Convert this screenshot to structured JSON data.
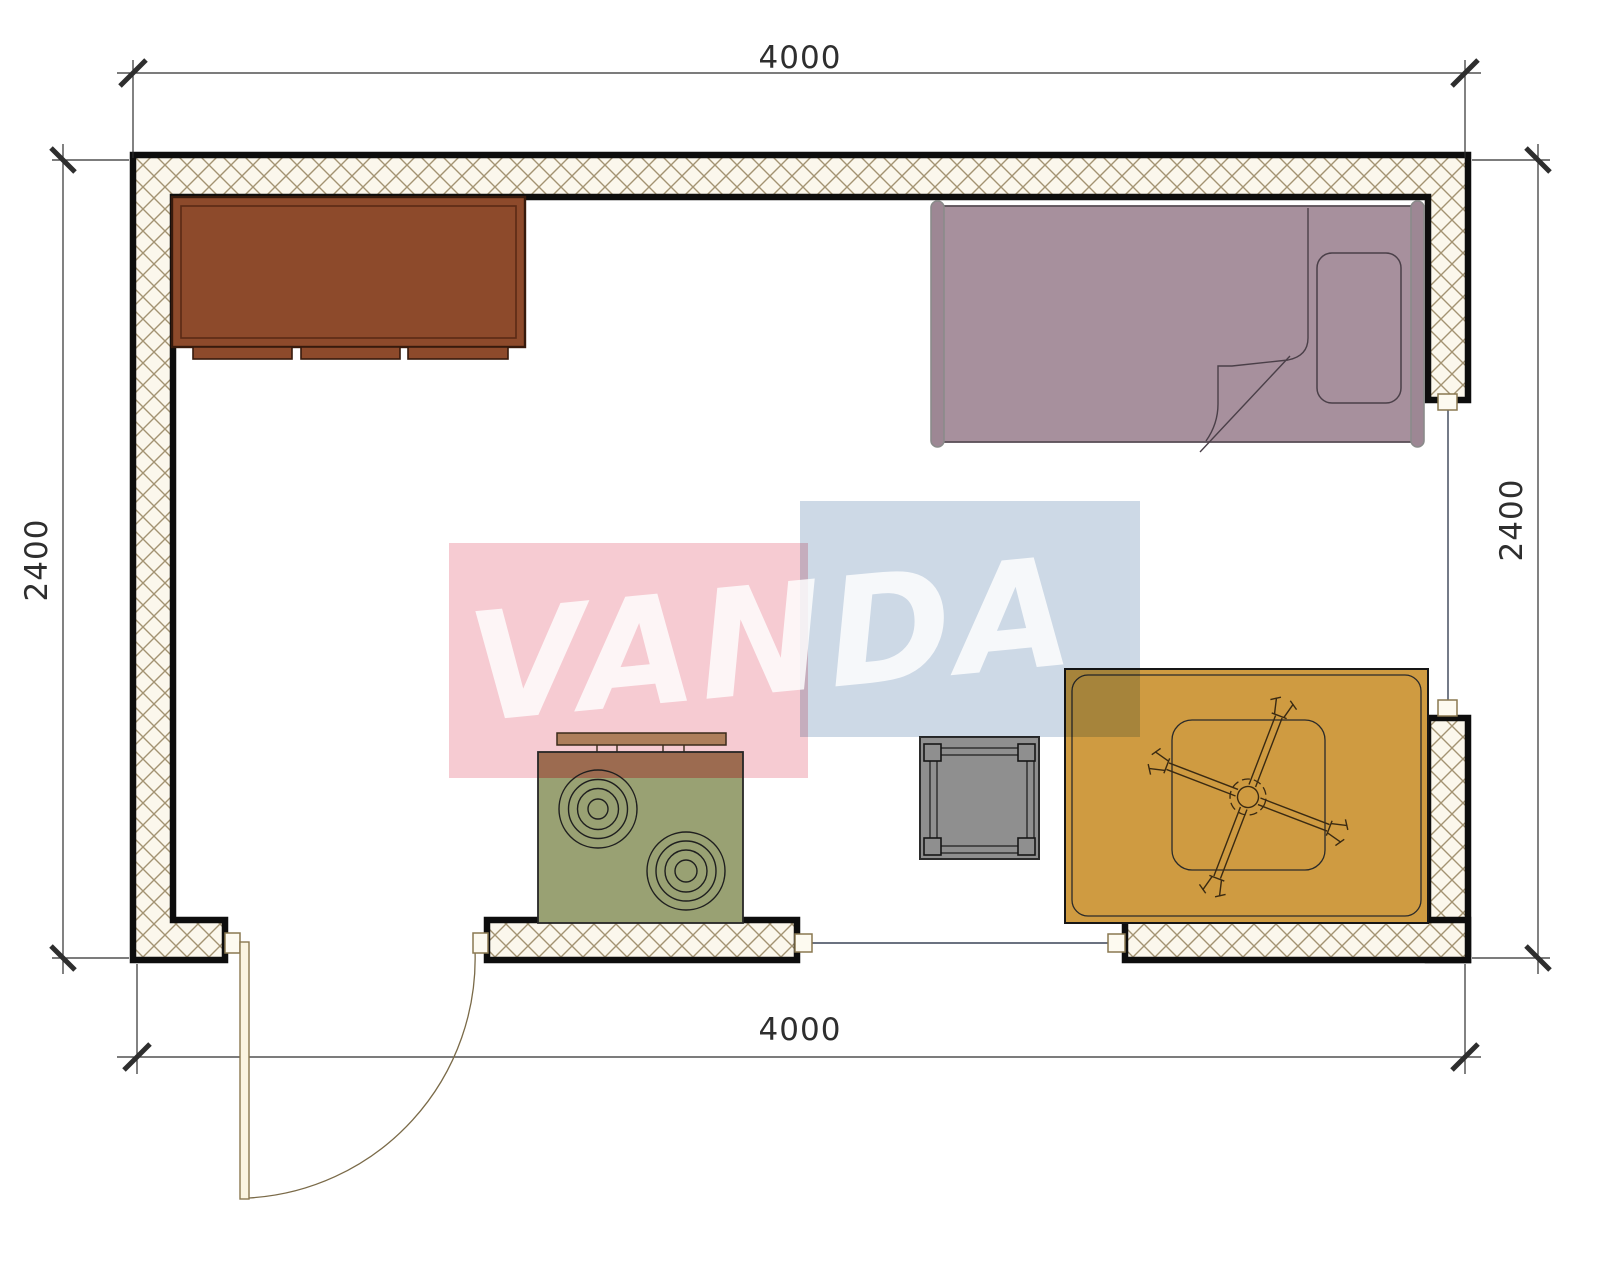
{
  "dimensions": {
    "top": "4000",
    "bottom": "4000",
    "left": "2400",
    "right": "2400"
  },
  "watermark": {
    "text": "VANDA",
    "pink_color": "#f6cbd2",
    "blue_color": "#cdd9e6",
    "text_color": "#ffffff"
  },
  "colors": {
    "paper": "#ffffff",
    "wall_outline": "#0d0d0d",
    "wall_hatch_bg": "#fbf7ec",
    "wall_hatch_line": "#a39372",
    "dimension": "#2e2e2e",
    "wardrobe": "#8d4a2b",
    "wardrobe_border": "#371a0c",
    "bed": "#a7909d",
    "bed_post": "#9d8794",
    "stove_body": "#99a173",
    "stove_band": "#9c6b50",
    "stove_shelf": "#ad7e5b",
    "side_table": "#8f8f8f",
    "activity_table": "#cf9b41",
    "door_leaf": "#fbf5e2",
    "door_frame": "#8a7850",
    "window_line": "#3a4356"
  }
}
